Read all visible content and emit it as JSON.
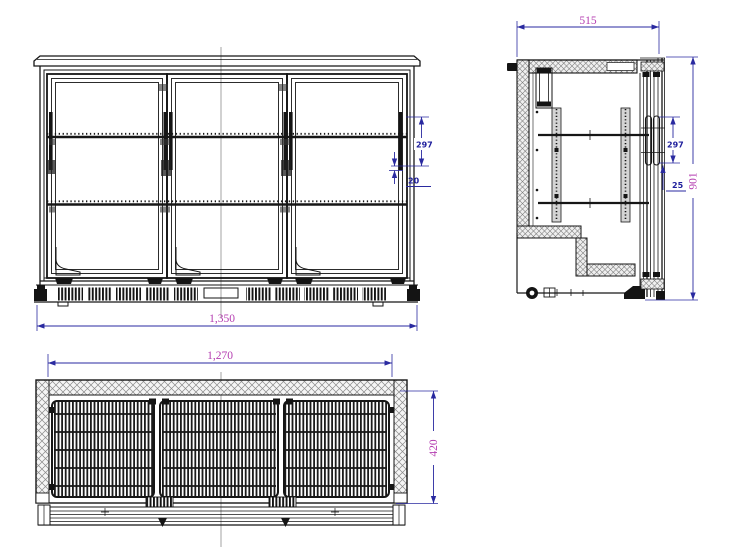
{
  "drawing": {
    "type": "technical-cad-drawing",
    "subject": "three-sliding-door back bar cooler, three orthographic views",
    "colors": {
      "line": "#161616",
      "dimension_line": "#2a2aa0",
      "dimension_text_major": "#b43cb0",
      "dimension_text_minor": "#1e1e9c",
      "centerline": "#999999"
    },
    "views": {
      "front": {
        "dim_width": "1,350",
        "dim_shelf_spacing": "297",
        "dim_shelf_offset": "20"
      },
      "side": {
        "dim_depth": "515",
        "dim_height": "901",
        "dim_shelf_spacing": "297",
        "dim_shelf_offset": "25"
      },
      "plan": {
        "dim_width": "1,270",
        "dim_depth": "420"
      }
    }
  }
}
